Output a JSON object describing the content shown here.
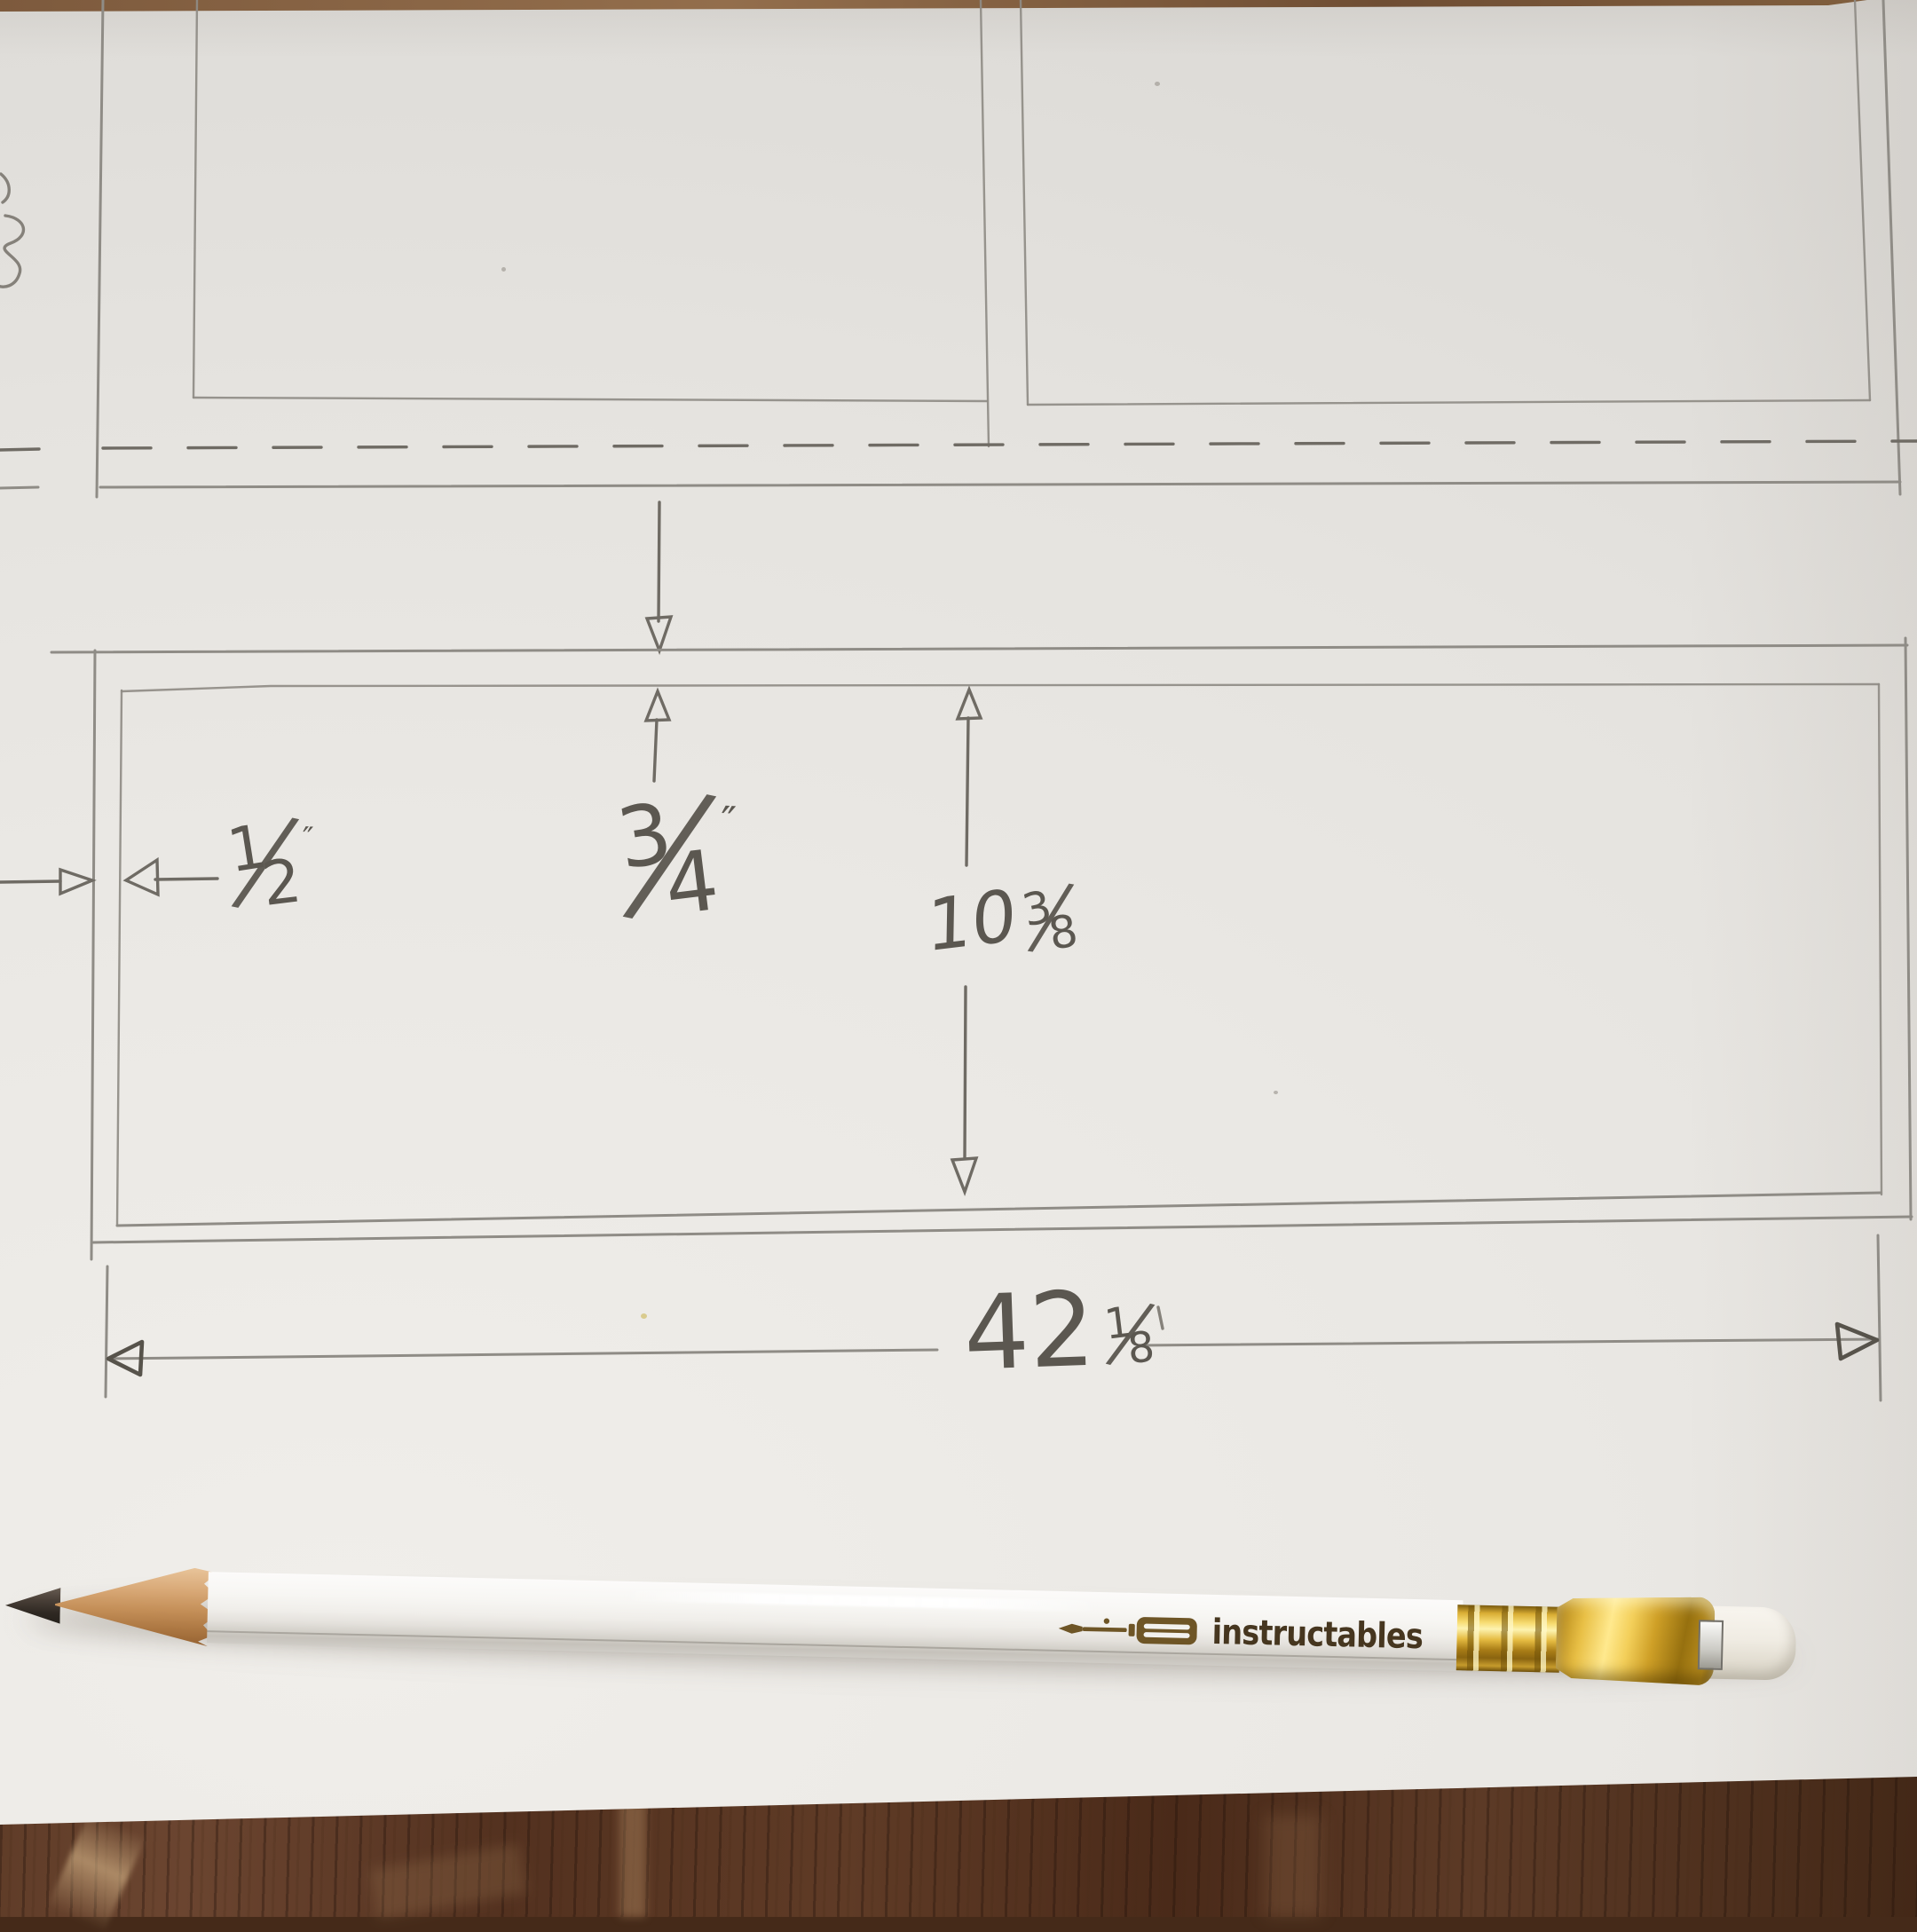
{
  "scene": {
    "paper_color": "#e9e7e3",
    "table_wood_color": "#53321f",
    "pencil_line_color": "#8f8c86",
    "handwriting_color": "#5b5750"
  },
  "sketch": {
    "fraction_slash": "⁄",
    "dim_side_margin": {
      "num": "1",
      "den": "2",
      "unit": "″"
    },
    "dim_top_margin": {
      "num": "3",
      "den": "4",
      "unit": "″"
    },
    "dim_panel_height": {
      "whole": "10",
      "num": "3",
      "den": "8"
    },
    "dim_panel_width": {
      "whole": "42",
      "num": "1",
      "den": "8"
    }
  },
  "pencil": {
    "brand": "instructables",
    "logo_icon": "screwdriver-icon",
    "body_color": "#f3f2ef",
    "ferrule_color": "#dcae33",
    "eraser_color": "#efebe1",
    "graphite_color": "#352e28",
    "wood_color": "#cf9a64"
  }
}
